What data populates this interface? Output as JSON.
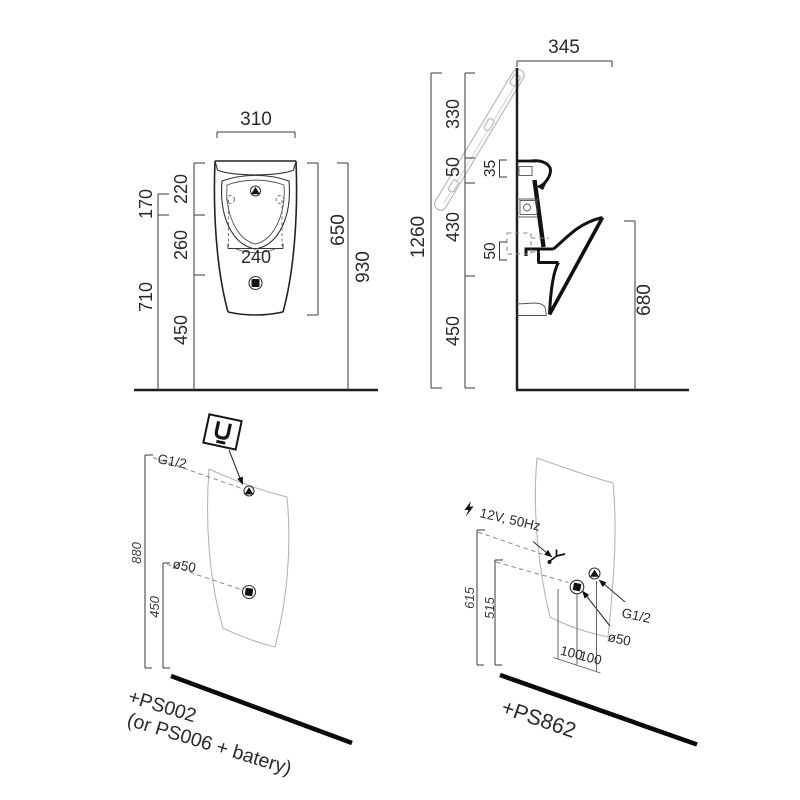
{
  "drawing": {
    "front_view": {
      "width_mm": "310",
      "bowl_cutout_width": "240",
      "left_outer_top": "170",
      "left_outer_bottom": "710",
      "left_inner_top": "220",
      "left_inner_mid": "260",
      "left_inner_bottom": "450",
      "right_inner": "650",
      "right_outer": "930"
    },
    "side_view": {
      "depth": "345",
      "overall_height": "1260",
      "chain_top": "330",
      "chain_upper": "50",
      "chain_mid": "430",
      "chain_bottom": "450",
      "rim_detail": "35",
      "outlet_detail": "50",
      "front_edge_height": "680"
    },
    "install_left": {
      "water_inlet_label": "G1/2",
      "drain_label": "ø50",
      "inlet_height": "880",
      "drain_height": "450",
      "kit_code": "+PS002",
      "kit_alt": "(or PS006 + batery)"
    },
    "install_right": {
      "power_label": "12V, 50Hz",
      "water_inlet_label": "G1/2",
      "drain_label": "ø50",
      "power_height": "615",
      "drain_height": "515",
      "offset_a": "100",
      "offset_b": "100",
      "kit_code": "+PS862"
    }
  }
}
